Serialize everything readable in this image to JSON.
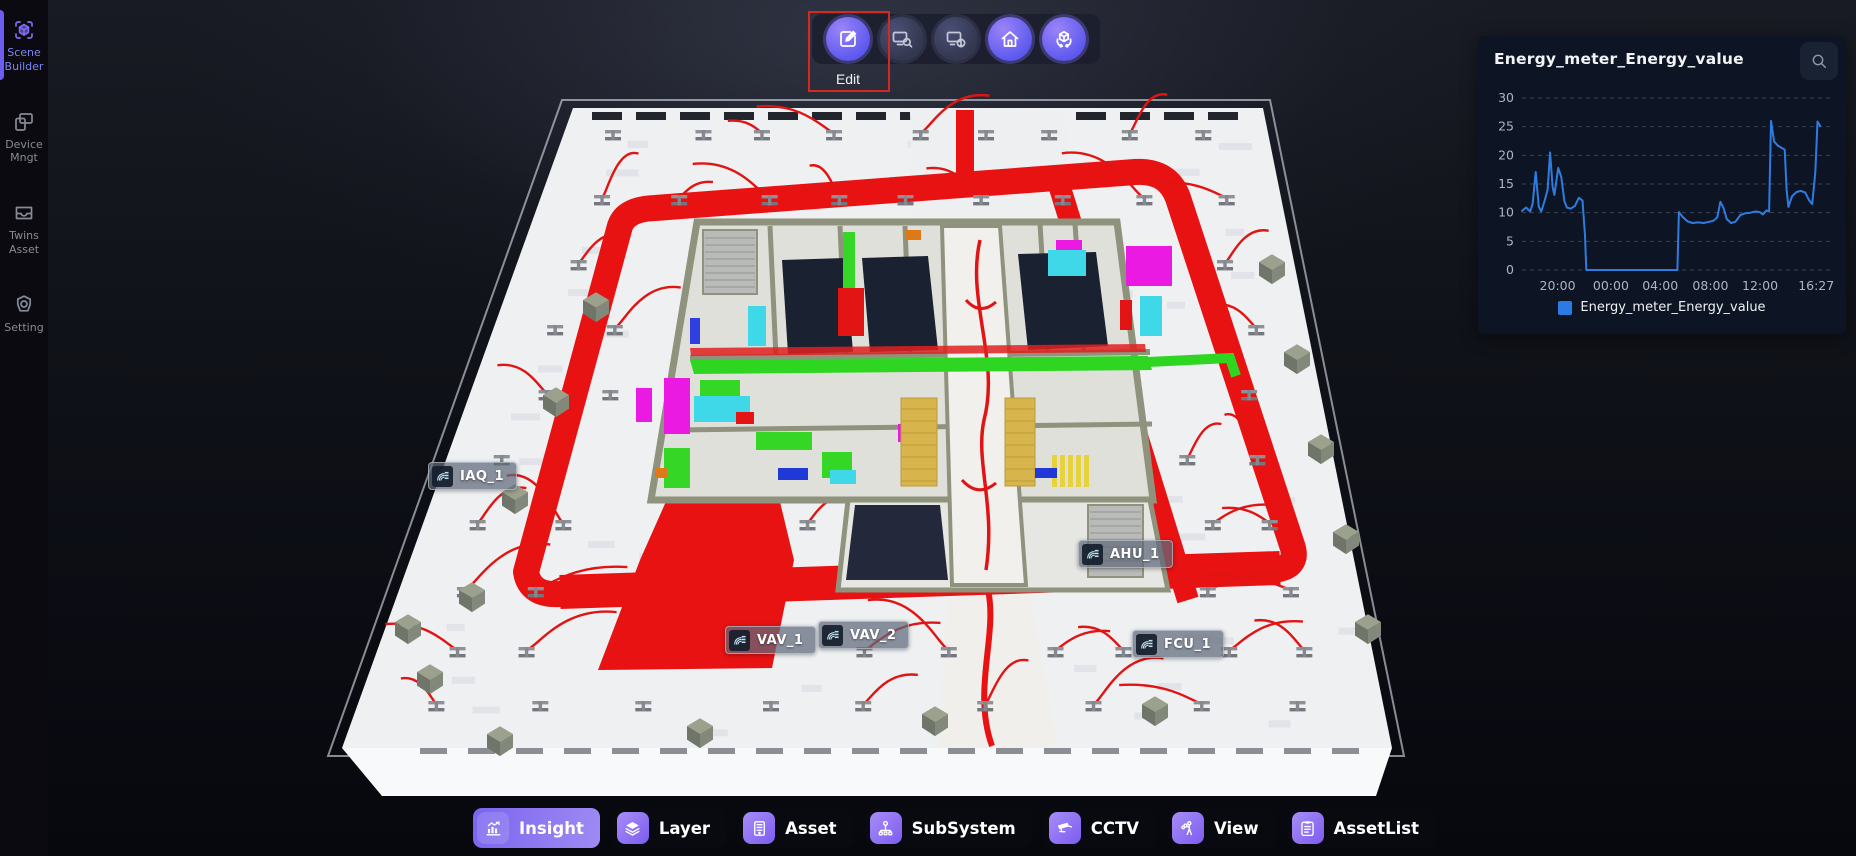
{
  "colors": {
    "accent_purple": "#7c5cf0",
    "highlight_red": "#d5281e",
    "pipe_red": "#e81212",
    "chart_line": "#2f7ce0",
    "legend_swatch": "#2b7be4"
  },
  "sidebar": {
    "items": [
      {
        "id": "scene-builder",
        "label": "Scene Builder",
        "icon": "scene-builder-icon",
        "active": true
      },
      {
        "id": "device-mngt",
        "label": "Device Mngt",
        "icon": "device-mngt-icon",
        "active": false
      },
      {
        "id": "twins-asset",
        "label": "Twins Asset",
        "icon": "twins-asset-icon",
        "active": false
      },
      {
        "id": "setting",
        "label": "Setting",
        "icon": "setting-icon",
        "active": false
      }
    ]
  },
  "top_toolbar": {
    "buttons": [
      {
        "id": "edit",
        "icon": "edit-icon",
        "label": "Edit",
        "bright": true,
        "highlighted": true
      },
      {
        "id": "device-search",
        "icon": "device-search-icon",
        "bright": false
      },
      {
        "id": "device-info",
        "icon": "device-info-icon",
        "bright": false
      },
      {
        "id": "home",
        "icon": "home-icon",
        "bright": true
      },
      {
        "id": "model-rotate",
        "icon": "model-rotate-icon",
        "bright": true
      }
    ]
  },
  "chart_panel": {
    "title": "Energy_meter_Energy_value",
    "legend": {
      "label": "Energy_meter_Energy_value",
      "color": "#2b7be4"
    },
    "chart_data": {
      "type": "line",
      "title": "Energy_meter_Energy_value",
      "series": [
        {
          "name": "Energy_meter_Energy_value",
          "points": [
            [
              0,
              10.3
            ],
            [
              1.3,
              10.9
            ],
            [
              2.6,
              10.2
            ],
            [
              3.4,
              11.5
            ],
            [
              4.4,
              17.1
            ],
            [
              5.4,
              11
            ],
            [
              6.2,
              10.2
            ],
            [
              7.2,
              12
            ],
            [
              8.2,
              14
            ],
            [
              9,
              20.5
            ],
            [
              9.8,
              14.5
            ],
            [
              10.4,
              13.1
            ],
            [
              11.6,
              17.8
            ],
            [
              12.6,
              16.2
            ],
            [
              13.6,
              12
            ],
            [
              14.4,
              10.9
            ],
            [
              15.6,
              10.7
            ],
            [
              17,
              11.2
            ],
            [
              18.2,
              12.6
            ],
            [
              19.4,
              12.1
            ],
            [
              20.2,
              6
            ],
            [
              20.6,
              0
            ],
            [
              49.8,
              0
            ],
            [
              50.3,
              10.1
            ],
            [
              51.6,
              9.2
            ],
            [
              53,
              8.5
            ],
            [
              54.6,
              8.2
            ],
            [
              56.4,
              8.3
            ],
            [
              58.2,
              8.2
            ],
            [
              60,
              8.4
            ],
            [
              61.4,
              8.6
            ],
            [
              62.6,
              9.2
            ],
            [
              63.6,
              11.9
            ],
            [
              64.6,
              10.8
            ],
            [
              65.6,
              8.9
            ],
            [
              67,
              8.2
            ],
            [
              68.4,
              8.4
            ],
            [
              70,
              9.6
            ],
            [
              71.6,
              9.9
            ],
            [
              73.2,
              10
            ],
            [
              74.8,
              10.2
            ],
            [
              76.2,
              10.1
            ],
            [
              77.2,
              9.7
            ],
            [
              78.4,
              10.4
            ],
            [
              79.2,
              10.2
            ],
            [
              79.8,
              26
            ],
            [
              80.8,
              22.4
            ],
            [
              82,
              21.7
            ],
            [
              83.2,
              21.3
            ],
            [
              84.2,
              21
            ],
            [
              84.8,
              14
            ],
            [
              85.4,
              11
            ],
            [
              86.6,
              12.9
            ],
            [
              88,
              13.6
            ],
            [
              89.4,
              13.8
            ],
            [
              90.8,
              13.5
            ],
            [
              92,
              12.2
            ],
            [
              93,
              11.5
            ],
            [
              94,
              17
            ],
            [
              94.7,
              25.9
            ],
            [
              95.6,
              25.1
            ]
          ]
        }
      ],
      "x_tick_labels": [
        "20:00",
        "00:00",
        "04:00",
        "08:00",
        "12:00",
        "16:27"
      ],
      "x_tick_fractions": [
        11.4,
        28.5,
        44.3,
        60.4,
        76.3,
        94.3
      ],
      "y_ticks": [
        0,
        5,
        10,
        15,
        20,
        25,
        30
      ],
      "ylim": [
        0,
        30
      ],
      "grid": "dashed-horizontal",
      "line_color": "#2f7ce0",
      "legend_position": "bottom"
    }
  },
  "scene": {
    "device_labels": [
      {
        "name": "IAQ_1"
      },
      {
        "name": "AHU_1"
      },
      {
        "name": "VAV_1"
      },
      {
        "name": "VAV_2"
      },
      {
        "name": "FCU_1"
      }
    ]
  },
  "bottom_toolbar": {
    "items": [
      {
        "id": "insight",
        "label": "Insight",
        "icon": "insight-icon",
        "active": true
      },
      {
        "id": "layer",
        "label": "Layer",
        "icon": "layer-icon",
        "active": false
      },
      {
        "id": "asset",
        "label": "Asset",
        "icon": "asset-icon",
        "active": false
      },
      {
        "id": "subsystem",
        "label": "SubSystem",
        "icon": "subsystem-icon",
        "active": false
      },
      {
        "id": "cctv",
        "label": "CCTV",
        "icon": "cctv-icon",
        "active": false
      },
      {
        "id": "view",
        "label": "View",
        "icon": "view-icon",
        "active": false
      },
      {
        "id": "assetlist",
        "label": "AssetList",
        "icon": "assetlist-icon",
        "active": false
      }
    ]
  }
}
